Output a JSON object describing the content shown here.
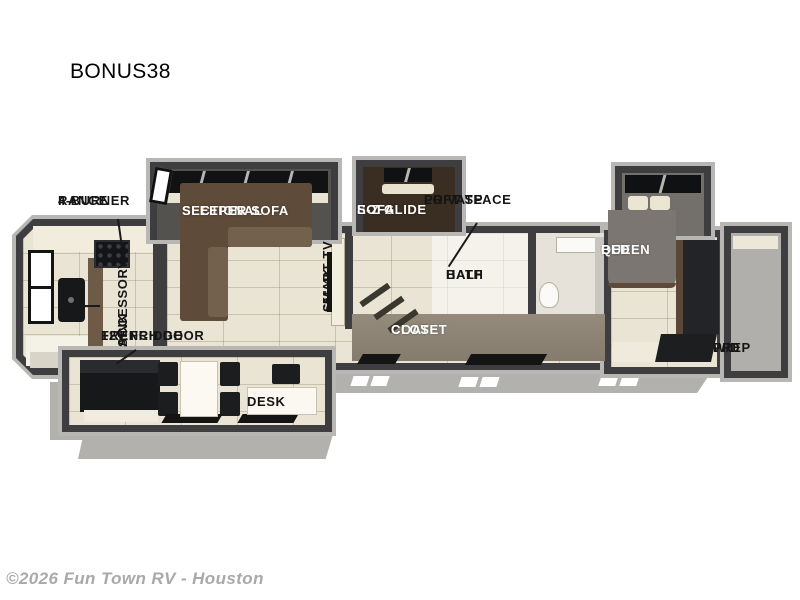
{
  "title": "BONUS38",
  "watermark": "©2026 Fun Town RV - Houston",
  "labels": {
    "burner_range": {
      "line1": "4-BURNER",
      "line2": "RANGE"
    },
    "accessory_sink": {
      "line1": "ACCESSORY",
      "line2": "SINK"
    },
    "sectional_sofa": {
      "line1": "SECTIONAL",
      "line2": "SLEEPER SOFA"
    },
    "smart_tv": {
      "line1": "65\" 4K",
      "line2": "SMART TV"
    },
    "ez_glide_sofa": {
      "line1": "E-Z GLIDE",
      "line2": "SOFA"
    },
    "private_loft": {
      "line1": "PRIVATE",
      "line2": "LOFT SPACE"
    },
    "half_bath": {
      "line1": "HALF",
      "line2": "BATH"
    },
    "coat_closet": {
      "line1": "COAT",
      "line2": "CLOSET"
    },
    "french_fridge": {
      "line1": "FRENCH DOOR",
      "line2": "12V FRIDGE"
    },
    "desk": {
      "line1": "DESK"
    },
    "queen_bed": {
      "line1": "QUEEN",
      "line2": "BED"
    },
    "wd_prep": {
      "line1": "W/D",
      "line2": "PREP"
    }
  },
  "colors": {
    "wall": "#3e3e40",
    "outer_rim": "#b9b7b4",
    "floor": "#e9e4d4",
    "sofa_brown": "#5e4b3a",
    "appliance_black": "#17181a",
    "bed_gray": "#7b7672",
    "skirt_gray": "#b3b1ae",
    "label_text": "#151515",
    "label_text_light": "#ffffff",
    "watermark_gray": "#a9a9a9"
  }
}
